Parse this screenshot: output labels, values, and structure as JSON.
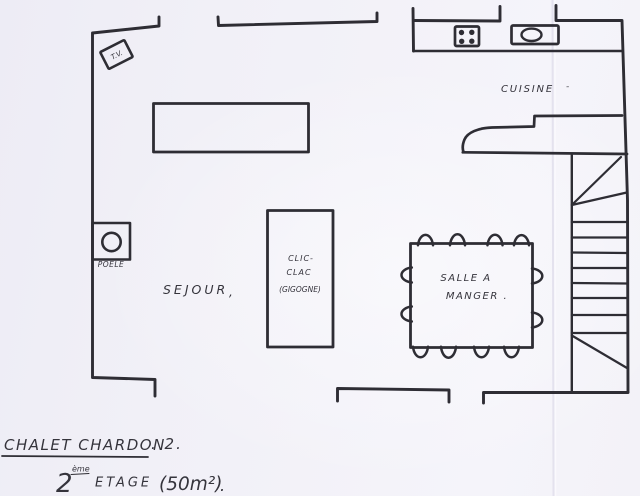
{
  "colors": {
    "paper": "#f2f1f7",
    "ink": "#2e2d34"
  },
  "rooms": {
    "sejour": {
      "label": "SEJOUR",
      "mark": ","
    },
    "cuisine": {
      "label": "CUISINE",
      "mark": "-"
    },
    "salle_a_manger": {
      "line1": "SALLE A",
      "line2": "MANGER ."
    }
  },
  "furniture": {
    "tv": {
      "label": "T.V."
    },
    "poele": {
      "label": "POELE"
    },
    "clic_clac": {
      "line1": "CLIC-",
      "line2": "CLAC",
      "line3": "(GIGOGNE)"
    }
  },
  "title": {
    "line1_main": "CHALET CHARDON",
    "line1_suffix": ". 2.",
    "line2_number": "2",
    "line2_ordinal": "ème",
    "line2_word": "ETAGE",
    "line2_area": "(50m²)",
    "line2_period": "."
  }
}
